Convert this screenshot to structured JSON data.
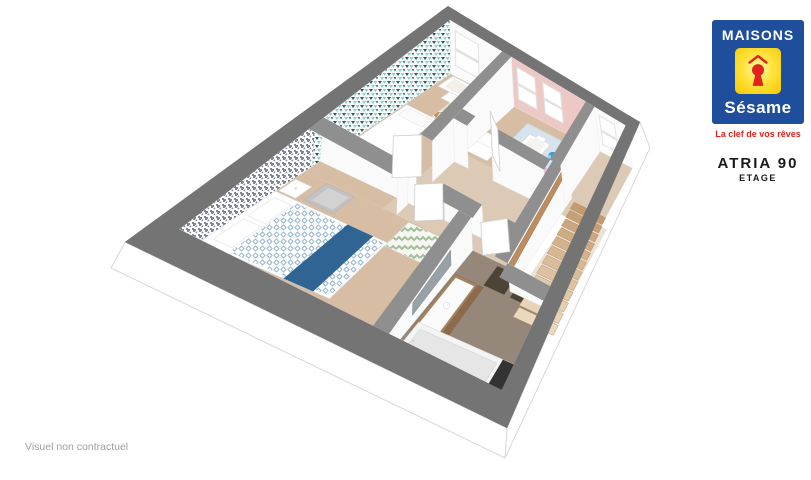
{
  "branding": {
    "logo": {
      "line1": "MAISONS",
      "line2": "Sésame",
      "blue": "#1e4e9c",
      "yellow": "#ffd900",
      "red": "#e2231a"
    },
    "tagline": "La clef de vos rêves"
  },
  "plan_header": {
    "model": "ATRIA 90",
    "level": "ETAGE"
  },
  "footer": {
    "disclaimer": "Visuel non contractuel"
  },
  "floorplan": {
    "rooms": [
      {
        "id": "master-bedroom"
      },
      {
        "id": "kids-bedroom-teal"
      },
      {
        "id": "kids-bedroom-pink"
      },
      {
        "id": "bathroom"
      },
      {
        "id": "hallway"
      },
      {
        "id": "landing"
      },
      {
        "id": "staircase"
      }
    ],
    "palette": {
      "extWallTop": "#747474",
      "intWallTop": "#8f8f8f",
      "wallFace": "#fafafa",
      "slab": "#ffffff",
      "slabEdge": "#d8d8d8",
      "woodFloor": "#d6bda4",
      "hallFloor": "#dccab6",
      "bathFloor": "#95877a",
      "lowerFloor": "#ece3d6",
      "stairWoodDark": "#c49a6f",
      "stairWoodLight": "#ecd9bd",
      "stairRail": "#bb8d5f",
      "pinkWall": "#edc9c6",
      "pinkBed": "#f0b4e2",
      "pinkBedStripe": "#e09cd2",
      "blueRug": "#d7e4ed",
      "toyBlue": "#3fa3d7",
      "runnerBlue": "#2f6493",
      "duvetBlue": "#8fb3d3",
      "grayMotif": "#7e8697",
      "tealDark": "#2e565c",
      "tealLight": "#8fd0ca",
      "tealBg": "#f4fbfa",
      "mosaicOrange": "#d2883f",
      "mosaicTeal": "#74b2ac",
      "mosaicDark": "#46505a",
      "mosaicCream": "#ecdfc9",
      "rugBase": "#f2ebdf",
      "chevGreen": "#a4bf9e",
      "furnStroke": "#dcdcdc",
      "chairGray": "#c2c2c2",
      "vanityWood": "#a5835f",
      "vanityWoodDark": "#8b6b4b",
      "matDark": "#4e4337",
      "tubInner": "#e6e6e6",
      "darkPanel": "#333333",
      "mirror": "#97a1a6",
      "windowFrame": "#e2e2e2"
    }
  }
}
